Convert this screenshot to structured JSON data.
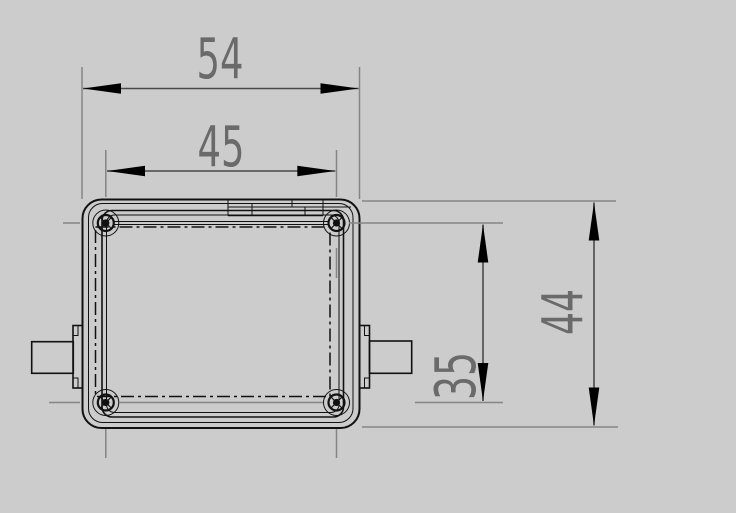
{
  "drawing": {
    "kind": "engineering-drawing",
    "view": "enclosure-top-view",
    "dimensions": {
      "overall_width": "54",
      "screw_spacing_width": "45",
      "screw_spacing_height": "35",
      "overall_height": "44"
    },
    "colors": {
      "background": "#cccccc",
      "geometry": "#111111",
      "dimension_line": "#4a4a4a",
      "extension_line": "#858585",
      "dimension_text": "#6a6a6a",
      "arrowhead": "#000000"
    }
  }
}
